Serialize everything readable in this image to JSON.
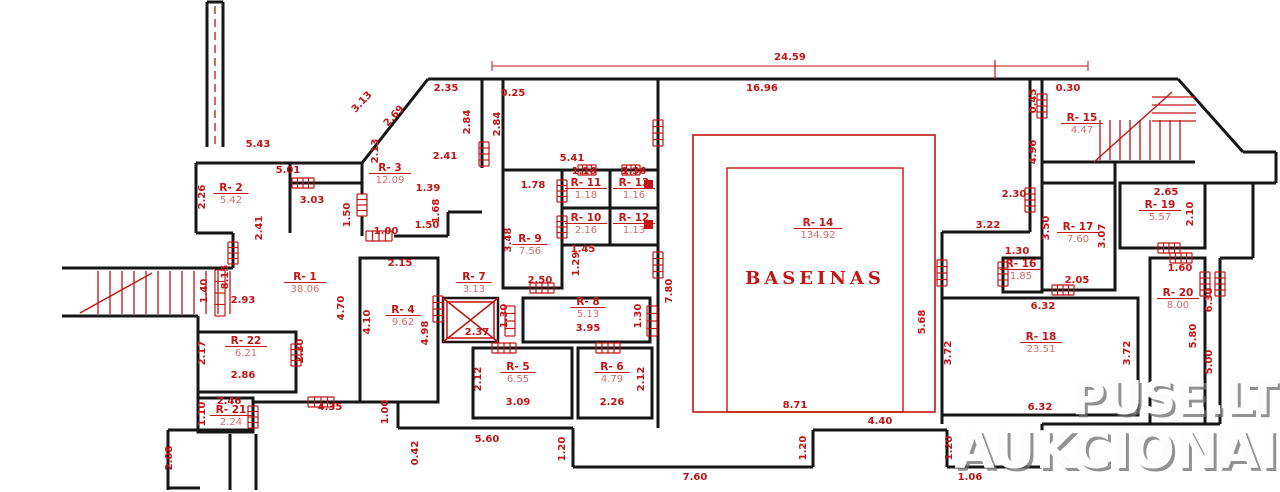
{
  "plan": {
    "caption": "BASEINAS",
    "annotation_color": "#c41414",
    "wall_color": "#161616",
    "rooms": [
      {
        "id": "R- 1",
        "area": "38.06",
        "x": 305,
        "y": 280
      },
      {
        "id": "R- 2",
        "area": "5.42",
        "x": 231,
        "y": 191
      },
      {
        "id": "R- 3",
        "area": "12.09",
        "x": 390,
        "y": 171
      },
      {
        "id": "R- 4",
        "area": "9.62",
        "x": 403,
        "y": 313
      },
      {
        "id": "R- 5",
        "area": "6.55",
        "x": 518,
        "y": 370
      },
      {
        "id": "R- 6",
        "area": "4.79",
        "x": 612,
        "y": 370
      },
      {
        "id": "R- 7",
        "area": "3.13",
        "x": 474,
        "y": 280
      },
      {
        "id": "R- 8",
        "area": "5.13",
        "x": 588,
        "y": 305
      },
      {
        "id": "R- 9",
        "area": "7.56",
        "x": 530,
        "y": 242
      },
      {
        "id": "R- 10",
        "area": "2.16",
        "x": 586,
        "y": 221
      },
      {
        "id": "R- 11",
        "area": "1.18",
        "x": 586,
        "y": 186
      },
      {
        "id": "R- 12",
        "area": "1.13",
        "x": 634,
        "y": 221
      },
      {
        "id": "R- 13",
        "area": "1.16",
        "x": 634,
        "y": 186
      },
      {
        "id": "R- 14",
        "area": "134.92",
        "x": 818,
        "y": 226
      },
      {
        "id": "R- 15",
        "area": "4.47",
        "x": 1082,
        "y": 121
      },
      {
        "id": "R- 16",
        "area": "1.85",
        "x": 1021,
        "y": 267
      },
      {
        "id": "R- 17",
        "area": "7.60",
        "x": 1078,
        "y": 230
      },
      {
        "id": "R- 18",
        "area": "23.51",
        "x": 1041,
        "y": 340
      },
      {
        "id": "R- 19",
        "area": "5.57",
        "x": 1160,
        "y": 208
      },
      {
        "id": "R- 20",
        "area": "8.00",
        "x": 1178,
        "y": 296
      },
      {
        "id": "R- 21",
        "area": "2.24",
        "x": 231,
        "y": 413
      },
      {
        "id": "R- 22",
        "area": "6.21",
        "x": 246,
        "y": 344
      }
    ],
    "dimensions": [
      {
        "v": "5.43",
        "x": 258,
        "y": 147,
        "r": 0
      },
      {
        "v": "3.13",
        "x": 364,
        "y": 104,
        "r": -47
      },
      {
        "v": "2.69",
        "x": 396,
        "y": 118,
        "r": -47
      },
      {
        "v": "2.35",
        "x": 446,
        "y": 91,
        "r": 0
      },
      {
        "v": "0.25",
        "x": 513,
        "y": 96,
        "r": 0
      },
      {
        "v": "2.84",
        "x": 470,
        "y": 122,
        "r": -90
      },
      {
        "v": "2.84",
        "x": 500,
        "y": 124,
        "r": -90
      },
      {
        "v": "2.41",
        "x": 445,
        "y": 159,
        "r": 0
      },
      {
        "v": "2.13",
        "x": 378,
        "y": 151,
        "r": -90
      },
      {
        "v": "24.59",
        "x": 790,
        "y": 60,
        "r": 0
      },
      {
        "v": "16.96",
        "x": 762,
        "y": 91,
        "r": 0
      },
      {
        "v": "0.30",
        "x": 1068,
        "y": 91,
        "r": 0
      },
      {
        "v": "0.45",
        "x": 1036,
        "y": 101,
        "r": -90
      },
      {
        "v": "4.96",
        "x": 1036,
        "y": 152,
        "r": -90
      },
      {
        "v": "2.30",
        "x": 1014,
        "y": 197,
        "r": 0
      },
      {
        "v": "3.22",
        "x": 988,
        "y": 228,
        "r": 0
      },
      {
        "v": "2.65",
        "x": 1166,
        "y": 195,
        "r": 0
      },
      {
        "v": "2.10",
        "x": 1193,
        "y": 214,
        "r": -90
      },
      {
        "v": "5.01",
        "x": 288,
        "y": 173,
        "r": 0
      },
      {
        "v": "2.26",
        "x": 205,
        "y": 197,
        "r": -90
      },
      {
        "v": "3.03",
        "x": 312,
        "y": 203,
        "r": 0
      },
      {
        "v": "2.41",
        "x": 262,
        "y": 228,
        "r": -90
      },
      {
        "v": "1.50",
        "x": 350,
        "y": 215,
        "r": -90
      },
      {
        "v": "1.39",
        "x": 428,
        "y": 191,
        "r": 0
      },
      {
        "v": "1.68",
        "x": 439,
        "y": 211,
        "r": -90
      },
      {
        "v": "1.50",
        "x": 427,
        "y": 228,
        "r": 0
      },
      {
        "v": "1.00",
        "x": 386,
        "y": 234,
        "r": 0
      },
      {
        "v": "5.41",
        "x": 572,
        "y": 161,
        "r": 0
      },
      {
        "v": "1.78",
        "x": 533,
        "y": 188,
        "r": 0
      },
      {
        "v": "1.16",
        "x": 584,
        "y": 174,
        "r": 0
      },
      {
        "v": "1.36",
        "x": 634,
        "y": 174,
        "r": 0
      },
      {
        "v": "3.48",
        "x": 511,
        "y": 240,
        "r": -90
      },
      {
        "v": "1.29",
        "x": 579,
        "y": 264,
        "r": -90
      },
      {
        "v": "1.45",
        "x": 583,
        "y": 252,
        "r": 0
      },
      {
        "v": "2.50",
        "x": 540,
        "y": 283,
        "r": 0
      },
      {
        "v": "8.15",
        "x": 228,
        "y": 277,
        "r": -90
      },
      {
        "v": "1.40",
        "x": 207,
        "y": 291,
        "r": -90
      },
      {
        "v": "2.93",
        "x": 243,
        "y": 303,
        "r": 0
      },
      {
        "v": "2.15",
        "x": 400,
        "y": 266,
        "r": 0
      },
      {
        "v": "4.70",
        "x": 344,
        "y": 308,
        "r": -90
      },
      {
        "v": "4.10",
        "x": 370,
        "y": 322,
        "r": -90
      },
      {
        "v": "4.98",
        "x": 428,
        "y": 333,
        "r": -90
      },
      {
        "v": "2.30",
        "x": 303,
        "y": 351,
        "r": -90
      },
      {
        "v": "2.17",
        "x": 205,
        "y": 353,
        "r": -90
      },
      {
        "v": "2.86",
        "x": 243,
        "y": 378,
        "r": 0
      },
      {
        "v": "1.30",
        "x": 507,
        "y": 316,
        "r": -90
      },
      {
        "v": "1.30",
        "x": 641,
        "y": 316,
        "r": -90
      },
      {
        "v": "2.37",
        "x": 477,
        "y": 335,
        "r": 0
      },
      {
        "v": "3.95",
        "x": 588,
        "y": 331,
        "r": 0
      },
      {
        "v": "2.12",
        "x": 481,
        "y": 379,
        "r": -90
      },
      {
        "v": "2.12",
        "x": 644,
        "y": 379,
        "r": -90
      },
      {
        "v": "3.09",
        "x": 518,
        "y": 405,
        "r": 0
      },
      {
        "v": "2.26",
        "x": 612,
        "y": 405,
        "r": 0
      },
      {
        "v": "4.35",
        "x": 330,
        "y": 410,
        "r": 0
      },
      {
        "v": "1.00",
        "x": 388,
        "y": 412,
        "r": -90
      },
      {
        "v": "0.42",
        "x": 418,
        "y": 453,
        "r": -90
      },
      {
        "v": "5.60",
        "x": 487,
        "y": 442,
        "r": 0
      },
      {
        "v": "1.20",
        "x": 565,
        "y": 449,
        "r": -90
      },
      {
        "v": "7.60",
        "x": 695,
        "y": 480,
        "r": 0
      },
      {
        "v": "8.71",
        "x": 795,
        "y": 408,
        "r": 0
      },
      {
        "v": "5.68",
        "x": 925,
        "y": 322,
        "r": -90
      },
      {
        "v": "7.80",
        "x": 672,
        "y": 291,
        "r": -90
      },
      {
        "v": "4.40",
        "x": 880,
        "y": 424,
        "r": 0
      },
      {
        "v": "1.20",
        "x": 806,
        "y": 448,
        "r": -90
      },
      {
        "v": "1.20",
        "x": 952,
        "y": 448,
        "r": -90
      },
      {
        "v": "1.06",
        "x": 970,
        "y": 480,
        "r": 0
      },
      {
        "v": "6.32",
        "x": 1043,
        "y": 309,
        "r": 0
      },
      {
        "v": "3.72",
        "x": 951,
        "y": 353,
        "r": -90
      },
      {
        "v": "3.72",
        "x": 1130,
        "y": 353,
        "r": -90
      },
      {
        "v": "6.32",
        "x": 1040,
        "y": 410,
        "r": 0
      },
      {
        "v": "2.05",
        "x": 1077,
        "y": 283,
        "r": 0
      },
      {
        "v": "1.30",
        "x": 1017,
        "y": 254,
        "r": 0
      },
      {
        "v": "3.50",
        "x": 1049,
        "y": 228,
        "r": -90
      },
      {
        "v": "3.07",
        "x": 1105,
        "y": 236,
        "r": -90
      },
      {
        "v": "1.60",
        "x": 1180,
        "y": 271,
        "r": 0
      },
      {
        "v": "5.80",
        "x": 1196,
        "y": 336,
        "r": -90
      },
      {
        "v": "6.30",
        "x": 1212,
        "y": 300,
        "r": -90
      },
      {
        "v": "5.00",
        "x": 1212,
        "y": 362,
        "r": -90
      },
      {
        "v": "1.10",
        "x": 205,
        "y": 414,
        "r": -90
      },
      {
        "v": "2.46",
        "x": 229,
        "y": 404,
        "r": 0
      },
      {
        "v": "2.08",
        "x": 172,
        "y": 458,
        "r": -90
      }
    ],
    "pool_room_id": "R- 14"
  },
  "watermark": {
    "line1": "PUSE.LT",
    "line2": "AUKCIONAI"
  }
}
